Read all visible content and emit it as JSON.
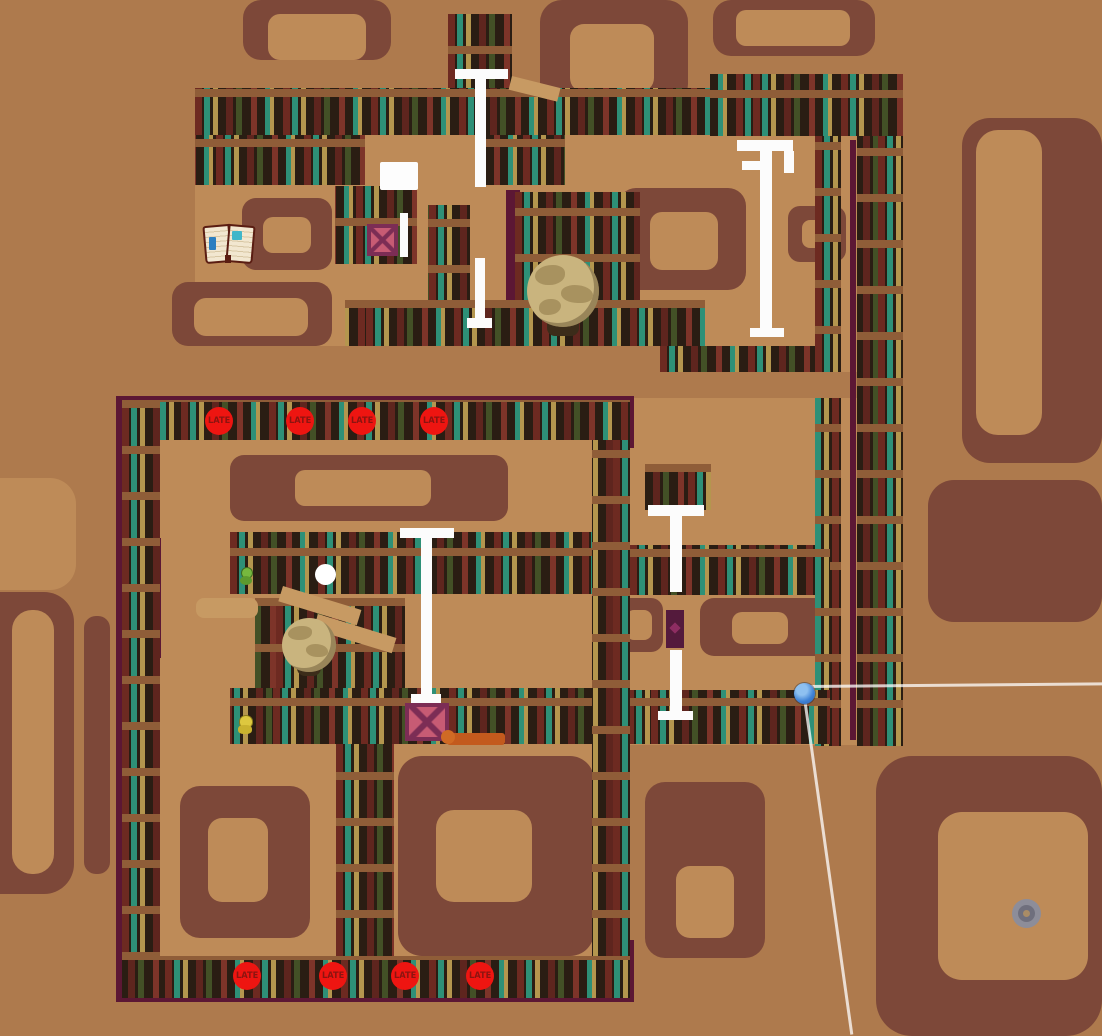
{
  "map": {
    "late_label": "LATE",
    "markers": {
      "top_row_count": 4,
      "bottom_row_count": 4,
      "total": 8
    },
    "colors": {
      "outer_background": "#ae7a4d",
      "floor": "#be8b58",
      "rug_brown": "#7d4839",
      "shelf_case": "#2a1d13",
      "shelf_board": "#8f5d38",
      "book_red": "#6d2a21",
      "book_teal": "#2e9077",
      "book_tan": "#b4964e",
      "book_olive": "#435026",
      "trim_maroon": "#5c1734",
      "late_red": "#ee1511",
      "late_text": "#8c1410",
      "ladder_white": "#fcfcfc",
      "player_blue": "#3f82d6",
      "globe_tan": "#c9b47e",
      "crate_frame": "#7c2d55",
      "crate_x_fill": "#c75b74",
      "ring_gray": "#8d8d99"
    },
    "sprites": [
      "open-book",
      "globe",
      "globe",
      "x-crate",
      "x-crate",
      "ladder",
      "ladder",
      "ladder",
      "ladder",
      "ladder",
      "ladder",
      "player-ball-blue",
      "white-ball",
      "gray-ring",
      "green-bookworm",
      "yellow-bookworm",
      "paper-sheet",
      "orange-sled",
      "purple-book"
    ]
  }
}
